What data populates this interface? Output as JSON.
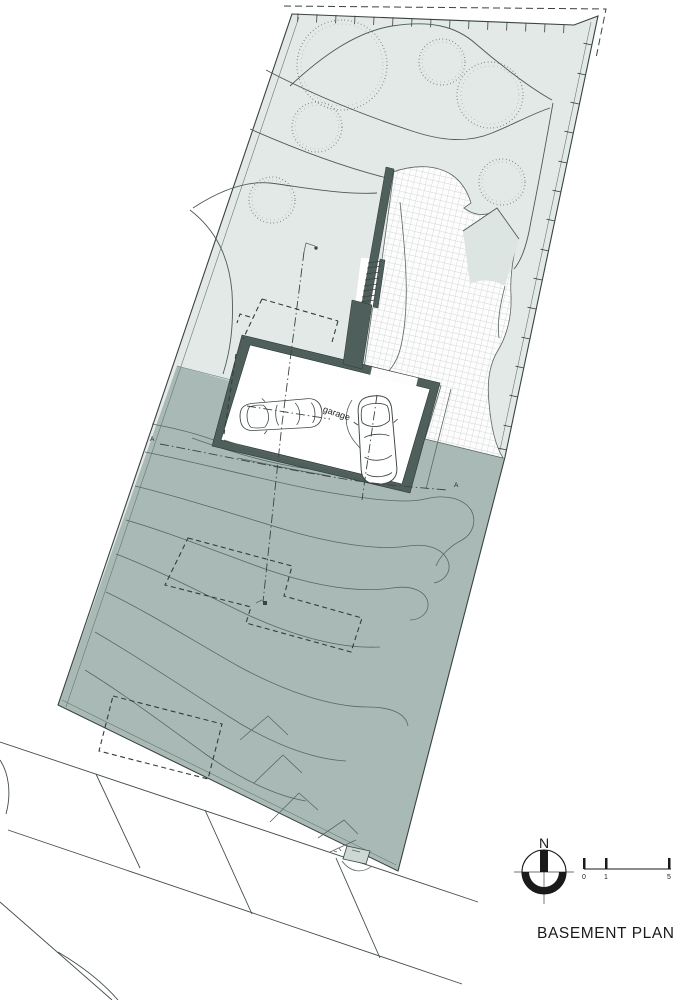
{
  "page_title": "BASEMENT PLAN",
  "plan": {
    "garage_label": "garage"
  },
  "compass": {
    "north_label": "N"
  },
  "scale_bar": {
    "tick_labels": [
      "0",
      "1",
      "5"
    ]
  },
  "section_markers": {
    "a_left": "A",
    "a_right": "A"
  },
  "colors": {
    "site_light": "#e3e9e7",
    "site_dark": "#a9bab6",
    "wall": "#4e5f5c",
    "wedge": "#dde5e3",
    "box": "#cdd8d5",
    "text": "#1a1a1a"
  }
}
